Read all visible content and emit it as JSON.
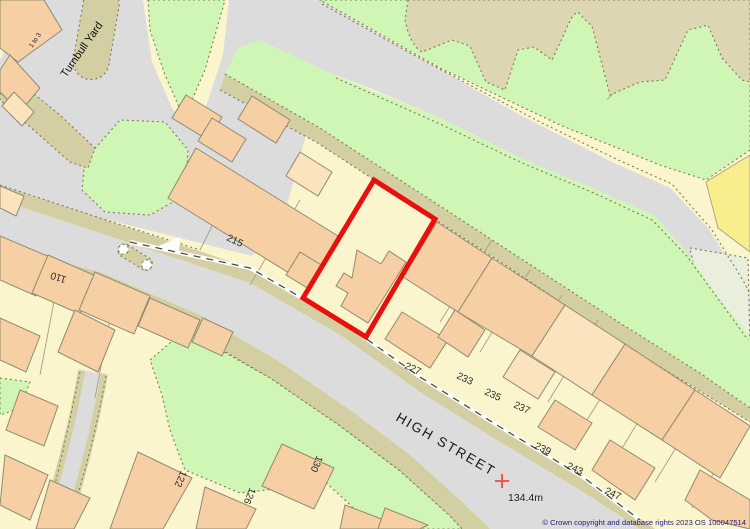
{
  "map": {
    "street_label": "HIGH STREET",
    "road_name": "Turnbull Yard",
    "building_range_label": "1 to 3",
    "spot_height": "134.4m",
    "copyright": "© Crown copyright and database rights 2023 OS 100047514",
    "house_numbers": [
      "215",
      "227",
      "233",
      "235",
      "237",
      "239",
      "243",
      "247",
      "110",
      "122",
      "126",
      "130"
    ],
    "highlight": {
      "meaning": "red property boundary outline"
    },
    "palette": {
      "plot": "#fbf5cd",
      "road": "#dcdcdc",
      "verge": "#d3cfa2",
      "green": "#d0f6b5",
      "scrub": "#dcd6b2",
      "building": "#f7cfa4",
      "building_light": "#fbe4bd",
      "outline": "#8f8b72",
      "parcel": "#a69f82",
      "dotline": "#7d7a58",
      "boundary_red": "#e8100c",
      "cross_red": "#ee5a50",
      "copyright": "#1c1c78",
      "pale_patch": "#e9eedd",
      "yellow_field": "#f9ee8e"
    }
  }
}
